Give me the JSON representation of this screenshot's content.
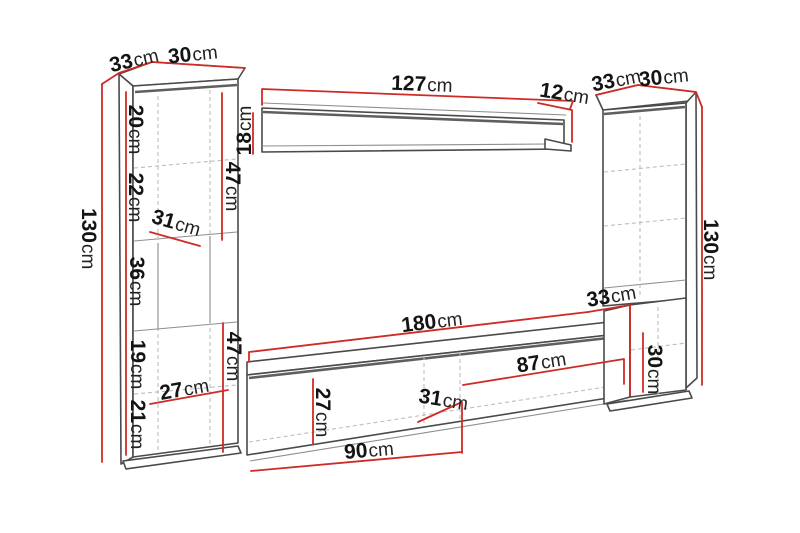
{
  "diagram": {
    "type": "furniture-dimension-drawing",
    "subject": "wall unit with two tall cabinets, wall shelf and TV stand",
    "unit": "cm",
    "colors": {
      "dim": "#cf2b26",
      "ink": "#4a4a4a",
      "txt": "#141414"
    },
    "labels": [
      {
        "id": "left-cabinet-top-depth",
        "value": "33",
        "unit": "cm"
      },
      {
        "id": "left-cabinet-top-width",
        "value": "30",
        "unit": "cm"
      },
      {
        "id": "left-cabinet-height",
        "value": "130",
        "unit": "cm"
      },
      {
        "id": "left-cabinet-section-1",
        "value": "20",
        "unit": "cm"
      },
      {
        "id": "left-cabinet-section-2",
        "value": "22",
        "unit": "cm"
      },
      {
        "id": "left-cabinet-section-3",
        "value": "36",
        "unit": "cm"
      },
      {
        "id": "left-cabinet-section-4",
        "value": "19",
        "unit": "cm"
      },
      {
        "id": "left-cabinet-section-5",
        "value": "21",
        "unit": "cm"
      },
      {
        "id": "left-cabinet-47-upper",
        "value": "47",
        "unit": "cm"
      },
      {
        "id": "left-cabinet-47-lower",
        "value": "47",
        "unit": "cm"
      },
      {
        "id": "left-cabinet-inner-width",
        "value": "31",
        "unit": "cm"
      },
      {
        "id": "left-cabinet-inner-depth",
        "value": "27",
        "unit": "cm"
      },
      {
        "id": "wall-shelf-length",
        "value": "127",
        "unit": "cm"
      },
      {
        "id": "wall-shelf-end-depth",
        "value": "12",
        "unit": "cm"
      },
      {
        "id": "wall-shelf-height",
        "value": "18",
        "unit": "cm"
      },
      {
        "id": "tv-stand-length",
        "value": "180",
        "unit": "cm"
      },
      {
        "id": "tv-stand-inner-height",
        "value": "27",
        "unit": "cm"
      },
      {
        "id": "tv-stand-mid-width",
        "value": "31",
        "unit": "cm"
      },
      {
        "id": "tv-stand-left-door",
        "value": "90",
        "unit": "cm"
      },
      {
        "id": "tv-stand-right-door",
        "value": "87",
        "unit": "cm"
      },
      {
        "id": "right-cabinet-top-depth",
        "value": "33",
        "unit": "cm"
      },
      {
        "id": "right-cabinet-top-width",
        "value": "30",
        "unit": "cm"
      },
      {
        "id": "right-cabinet-height",
        "value": "130",
        "unit": "cm"
      },
      {
        "id": "right-cabinet-depth",
        "value": "33",
        "unit": "cm"
      },
      {
        "id": "right-cabinet-base-height",
        "value": "30",
        "unit": "cm"
      }
    ]
  }
}
